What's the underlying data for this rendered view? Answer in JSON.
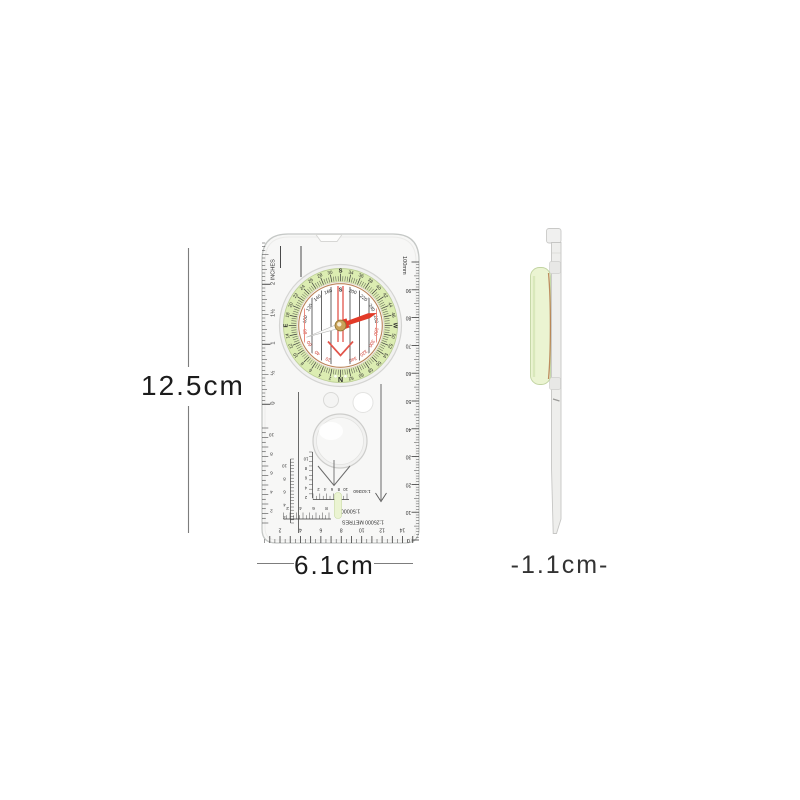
{
  "annotations": {
    "height_label": "12.5cm",
    "width_label": "6.1cm",
    "thickness_label": "-1.1cm-"
  },
  "compass": {
    "needle_angle_deg": -19,
    "bezel_labels": [
      "S",
      "34",
      "36",
      "38",
      "40",
      "42",
      "44",
      "46",
      "W",
      "50",
      "52",
      "54",
      "56",
      "58",
      "60",
      "62",
      "N",
      "2",
      "4",
      "6",
      "8",
      "10",
      "12",
      "14",
      "E",
      "18",
      "20",
      "22",
      "24",
      "26",
      "28",
      "30"
    ],
    "dial_labels": [
      {
        "t": "100",
        "a": -80,
        "c": "b"
      },
      {
        "t": "120",
        "a": -60,
        "c": "b"
      },
      {
        "t": "140",
        "a": -40,
        "c": "b"
      },
      {
        "t": "160",
        "a": -20,
        "c": "b"
      },
      {
        "t": "S",
        "a": 0,
        "c": "b"
      },
      {
        "t": "200",
        "a": 20,
        "c": "b"
      },
      {
        "t": "220",
        "a": 40,
        "c": "b"
      },
      {
        "t": "240",
        "a": 60,
        "c": "b"
      },
      {
        "t": "260",
        "a": 80,
        "c": "b"
      },
      {
        "t": "280",
        "a": 100,
        "c": "r"
      },
      {
        "t": "300",
        "a": 120,
        "c": "r"
      },
      {
        "t": "320",
        "a": 140,
        "c": "r"
      },
      {
        "t": "340",
        "a": 160,
        "c": "r"
      },
      {
        "t": "20",
        "a": -160,
        "c": "r"
      },
      {
        "t": "40",
        "a": -140,
        "c": "r"
      },
      {
        "t": "60",
        "a": -120,
        "c": "r"
      },
      {
        "t": "80",
        "a": -100,
        "c": "r"
      }
    ],
    "rulers": {
      "inch_labels": [
        "2 INCHES",
        "1½",
        "1",
        "½",
        "0"
      ],
      "mm_unit_label": "100mm",
      "mm_numbers": [
        "90",
        "80",
        "70",
        "60",
        "50",
        "40",
        "30",
        "20",
        "10",
        "0"
      ],
      "bottom_numbers": [
        "2",
        "4",
        "6",
        "8",
        "10",
        "12",
        "14"
      ],
      "left_scale_numbers": [
        "10",
        "8",
        "6",
        "4",
        "2"
      ],
      "inner_scale_numbers": [
        "10",
        "8",
        "6",
        "4",
        "2"
      ],
      "mini_scale_numbers": [
        "10",
        "8",
        "6",
        "4",
        "2"
      ],
      "scale1_numbers": [
        "2",
        "4",
        "6",
        "8",
        "10"
      ],
      "scale2_numbers": [
        "2",
        "4",
        "6",
        "8"
      ]
    },
    "scales": {
      "scale1": "1:63360",
      "scale2": "1:50000",
      "scale3": "1:25000 METRES"
    },
    "colors": {
      "bezel_green": "#dcedb2",
      "capsule_green": "#ebf4d2",
      "needle_red": "#e23a28",
      "number_red": "#cc3b30",
      "copper": "#b5794a",
      "hub_gold": "#c9a258"
    }
  }
}
